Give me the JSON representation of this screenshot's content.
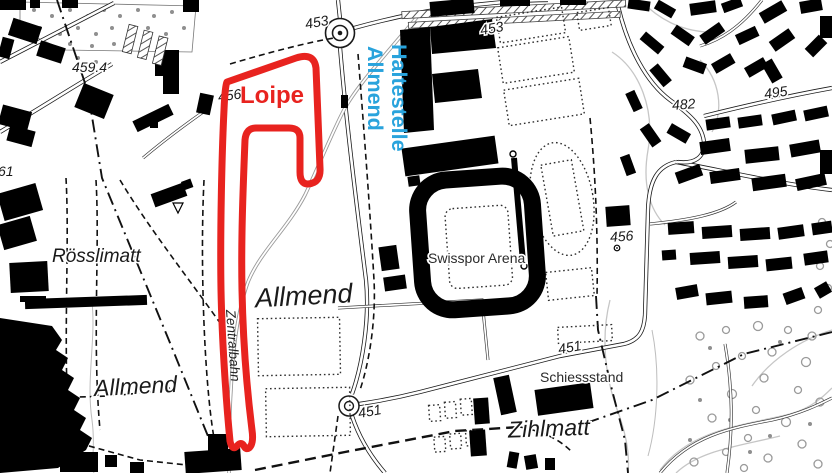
{
  "annotations": {
    "loipe": {
      "label": "Loipe",
      "color": "#e8231f"
    },
    "stop": {
      "line1": "Haltestelle",
      "line2": "Allmend",
      "color": "#29a3dc"
    }
  },
  "labels": {
    "places": {
      "roesslimatt": "Rösslimatt",
      "allmend_center": "Allmend",
      "allmend_sw": "Allmend",
      "zihlmatt": "Zihlmatt",
      "swisspor_arena": "Swisspor Arena",
      "schiessstand": "Schiessstand",
      "zentralbahn": "Zentralbahn"
    },
    "elevations": {
      "e459_4": "459.4",
      "e456_w": "456",
      "e453_roundabout": "453",
      "e453_ne": "453",
      "e482": "482",
      "e495": "495",
      "e456_e": "456",
      "e451_center": "451",
      "e451_e": "451",
      "e61": "61"
    }
  },
  "map_symbols": {
    "roundabout": "roundabout",
    "turning_circle": "turning-circle",
    "survey_point": "survey-point",
    "railway": "Zentralbahn railway line",
    "stadium": "Swisspor Arena stadium",
    "running_track": "athletics track"
  }
}
